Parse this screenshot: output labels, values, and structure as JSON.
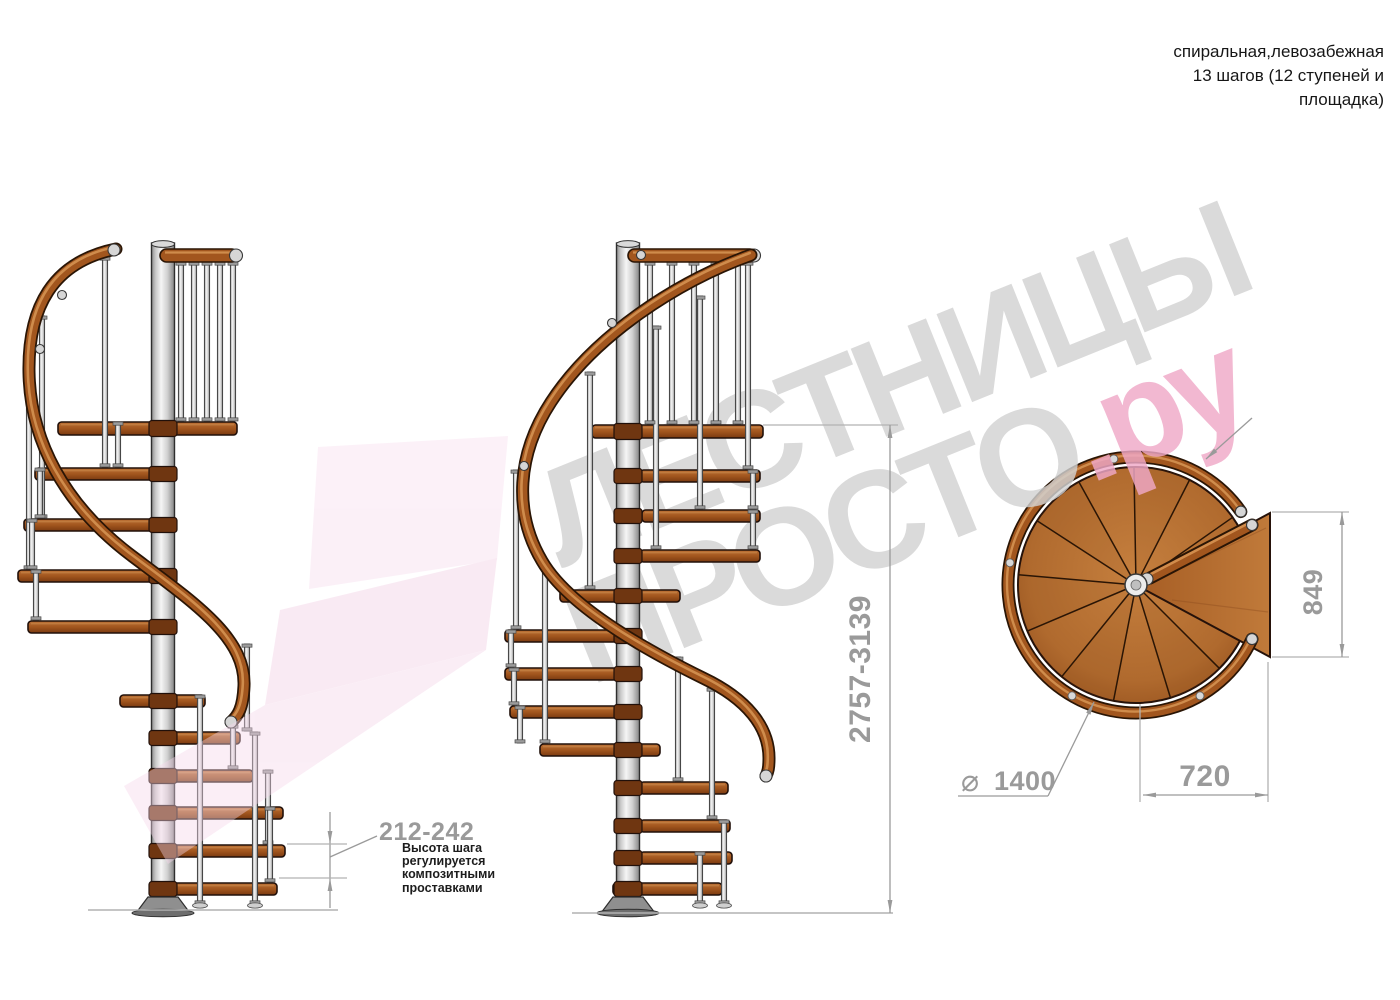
{
  "header": {
    "lines": [
      "спиральная,левозабежная",
      "13 шагов (12 ступеней и",
      "площадка)"
    ]
  },
  "watermark": {
    "brand_top": "ЛЕСТНИЦЫ",
    "brand_bottom": "ПРОСТО",
    "brand_suffix": ".ру"
  },
  "annotations": {
    "step_height": {
      "label": "212-242",
      "note_lines": [
        "Высота шага",
        "регулируется",
        "композитными",
        "проставками"
      ]
    },
    "total_height": {
      "label": "2757-3139"
    },
    "plan": {
      "platform_depth": "849",
      "platform_width": "720",
      "diameter_symbol": "⌀",
      "diameter_value": "1400"
    }
  },
  "colors": {
    "dimension": "#9a9a9a",
    "wood": "#a2561e",
    "wood_light": "#c07a35",
    "metal": "#e8e8e8",
    "watermark_gray": "#d2d2d2",
    "watermark_pink": "#f0a9c8",
    "arrow_pink": "#f5d6e9"
  }
}
